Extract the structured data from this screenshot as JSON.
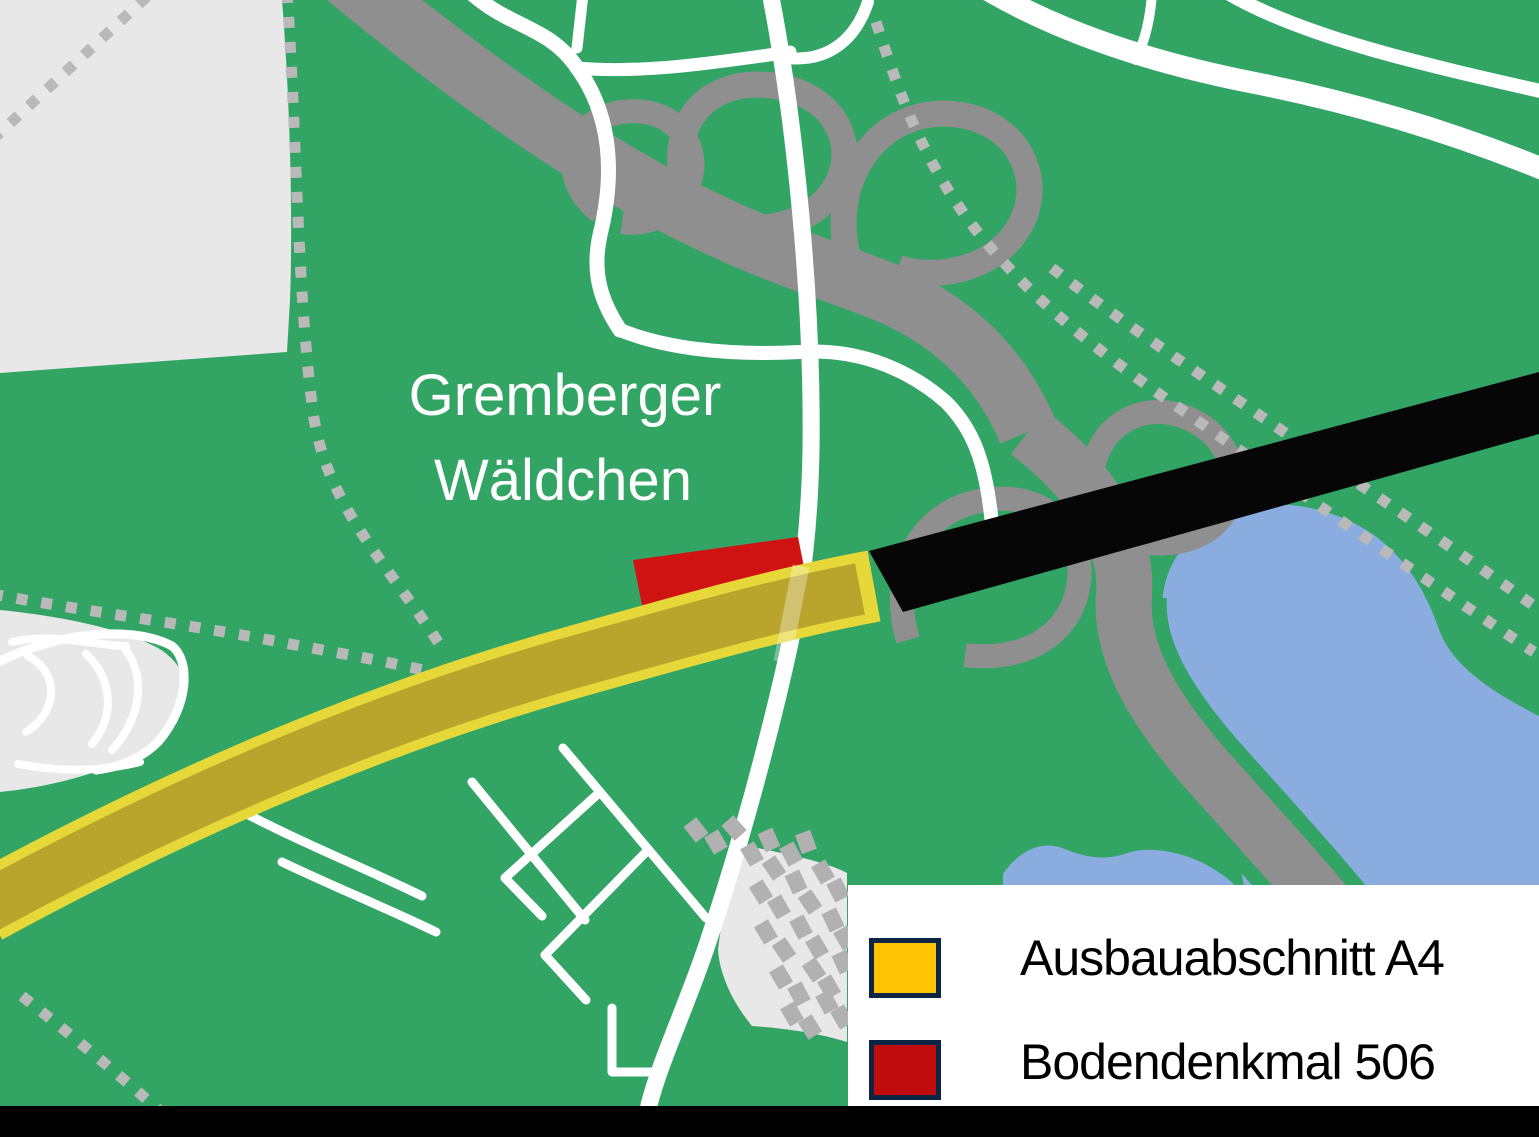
{
  "map": {
    "area_label": {
      "line1": "Gremberger",
      "line2": "Wäldchen"
    },
    "colors": {
      "green": "#32a565",
      "water": "#8bacdf",
      "area_gray": "#e8e8e8",
      "building_gray": "#b1b1b1",
      "road_gray": "#8f8f8f",
      "dot_gray": "#b9b9b9",
      "road_white": "#ffffff",
      "band_yellow_edge": "#e6d839",
      "band_yellow_core": "#b9a52c",
      "band_black": "#060606",
      "marker_red": "#cf1313"
    }
  },
  "legend": {
    "panel_color": "#ffffff",
    "swatch_border_color": "#0d2444",
    "items": [
      {
        "id": "ausbauabschnitt-a4",
        "swatch_color": "#fec303",
        "label": "Ausbauabschnitt A4"
      },
      {
        "id": "bodendenkmal-506",
        "swatch_color": "#c00c0c",
        "label": "Bodendenkmal 506"
      }
    ]
  },
  "footer": {
    "bar_color": "#000000"
  }
}
